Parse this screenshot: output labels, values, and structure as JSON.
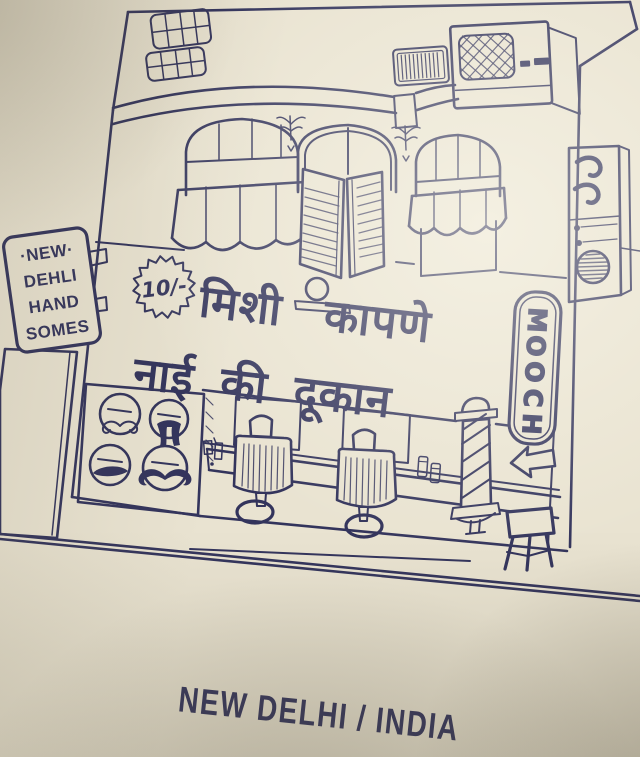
{
  "colors": {
    "paper": "#e9e3d1",
    "ink": "#33345c",
    "caption_ink": "#25263f"
  },
  "postcard": {
    "side_sign": {
      "lines": [
        "·NEW·",
        "DEHLI",
        "HAND",
        "SOMES"
      ]
    },
    "price_badge": {
      "text": "10/-"
    },
    "shop_name": {
      "line1": "मिशी कापणे",
      "line2": "नाई की दूकान"
    },
    "vertical_sign": {
      "word": "MOOCH",
      "letters": [
        "M",
        "O",
        "O",
        "C",
        "H"
      ]
    },
    "caption": {
      "text": "NEW DELHI / INDIA"
    },
    "icons": {
      "arrow": "left-arrow",
      "barber_pole": "barber-pole",
      "fan": "round-fan-grille",
      "mustache_styles": [
        "curled-handlebar",
        "horseshoe",
        "thick-chevron",
        "bold-handlebar"
      ]
    }
  }
}
